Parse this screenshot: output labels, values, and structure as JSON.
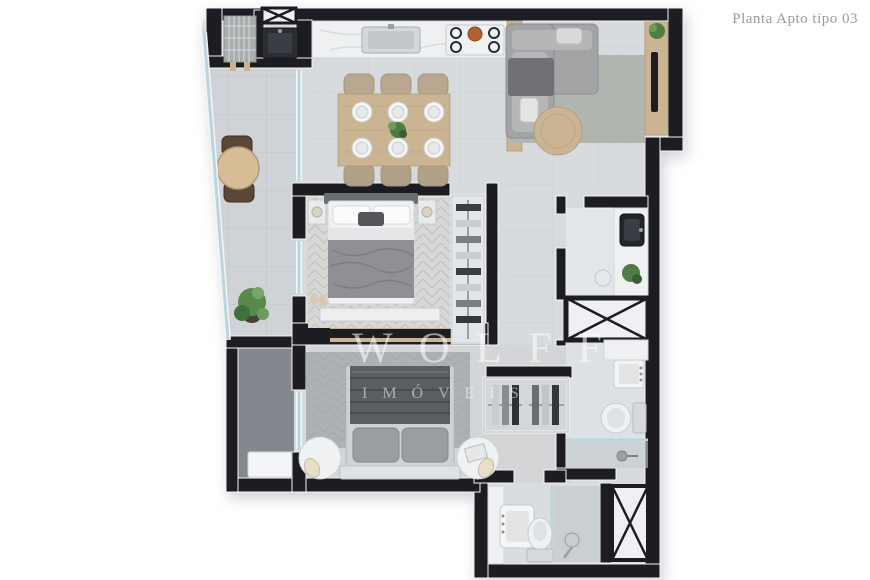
{
  "header": {
    "title": "Planta Apto tipo 03",
    "title_color": "#9b9b9b"
  },
  "watermark": {
    "brand": "WOLFF",
    "tagline": "IMÓVEIS",
    "color": "#ffffff"
  },
  "palette": {
    "background": "#ffffff",
    "wall": "#1b1e22",
    "floor_main": "#d8dbde",
    "floor_balcony": "#cfd3d7",
    "floor_service": "#84888e",
    "floor_bath": "#e0e3e6",
    "rug_living": "#b2b6b0",
    "rug_bedroom": "#adb0b4",
    "wood": "#cbb492",
    "marble": "#eef0f1",
    "sofa": "#a3a4a6",
    "blanket_light": "#8e9094",
    "blanket_dark": "#5a5d62",
    "plant": "#4f7d44",
    "glass": "#bcd4dc"
  },
  "floorplan": {
    "rooms": [
      {
        "id": "balcony",
        "furniture": [
          "bistro-table",
          "bistro-chair",
          "bistro-chair",
          "potted-plant"
        ]
      },
      {
        "id": "laundry",
        "furniture": [
          "drying-rack",
          "utility-sink",
          "duct-shaft"
        ]
      },
      {
        "id": "kitchen",
        "furniture": [
          "counter",
          "kitchen-sink",
          "cooktop-5-burners"
        ]
      },
      {
        "id": "dining",
        "furniture": [
          "wood-table",
          "six-chairs",
          "six-place-settings",
          "centerpiece"
        ]
      },
      {
        "id": "living",
        "furniture": [
          "l-shaped-sofa",
          "round-coffee-table",
          "rug",
          "tv-panel",
          "tv",
          "plant"
        ]
      },
      {
        "id": "bedroom-1",
        "furniture": [
          "double-bed",
          "nightstand",
          "nightstand",
          "wardrobe-with-clothes",
          "foot-dresser",
          "chevron-rug"
        ]
      },
      {
        "id": "bathroom-1",
        "furniture": [
          "marble-vanity",
          "dark-vessel-sink",
          "plant",
          "hamper"
        ]
      },
      {
        "id": "duct-shaft-1",
        "furniture": [
          "x-cross"
        ]
      },
      {
        "id": "bathroom-2",
        "furniture": [
          "marble-counter",
          "sink",
          "toilet",
          "glass-shower"
        ]
      },
      {
        "id": "bedroom-2",
        "furniture": [
          "double-bed-dark-duvet",
          "round-nightstand",
          "round-nightstand",
          "lamps",
          "chevron-rug",
          "open-wardrobe-with-clothes"
        ]
      },
      {
        "id": "bathroom-3",
        "furniture": [
          "marble-vanity",
          "sink",
          "toilet",
          "glass-shower",
          "shower-head",
          "duct-shaft"
        ]
      },
      {
        "id": "service-room",
        "furniture": [
          "ac-unit"
        ]
      }
    ]
  }
}
